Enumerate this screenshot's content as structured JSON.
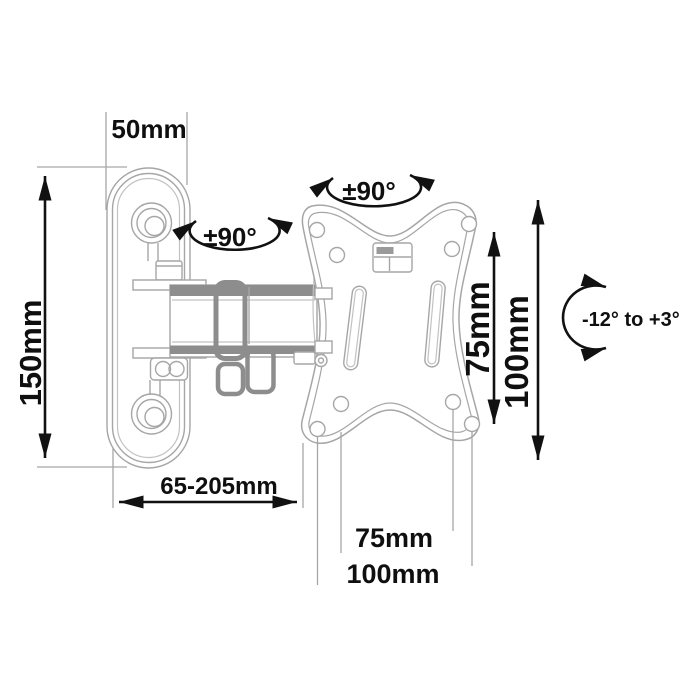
{
  "page": {
    "background": "#ffffff"
  },
  "diagram": {
    "subject": "articulating-tv-wall-mount-technical-drawing",
    "colors": {
      "outline": "#a6a6a6",
      "outline_dark": "#8d8d8d",
      "dimension_ink": "#111111",
      "background": "#ffffff"
    },
    "dimensions": {
      "bracket_width": "50mm",
      "wall_plate_height": "150mm",
      "extension_range": "65-205mm",
      "vesa_side_75": "75mm",
      "vesa_side_100": "100mm",
      "vesa_bottom_75": "75mm",
      "vesa_bottom_100": "100mm"
    },
    "angles": {
      "wall_swivel": "±90°",
      "plate_swivel": "±90°",
      "tilt_range": "-12° to +3°"
    }
  }
}
